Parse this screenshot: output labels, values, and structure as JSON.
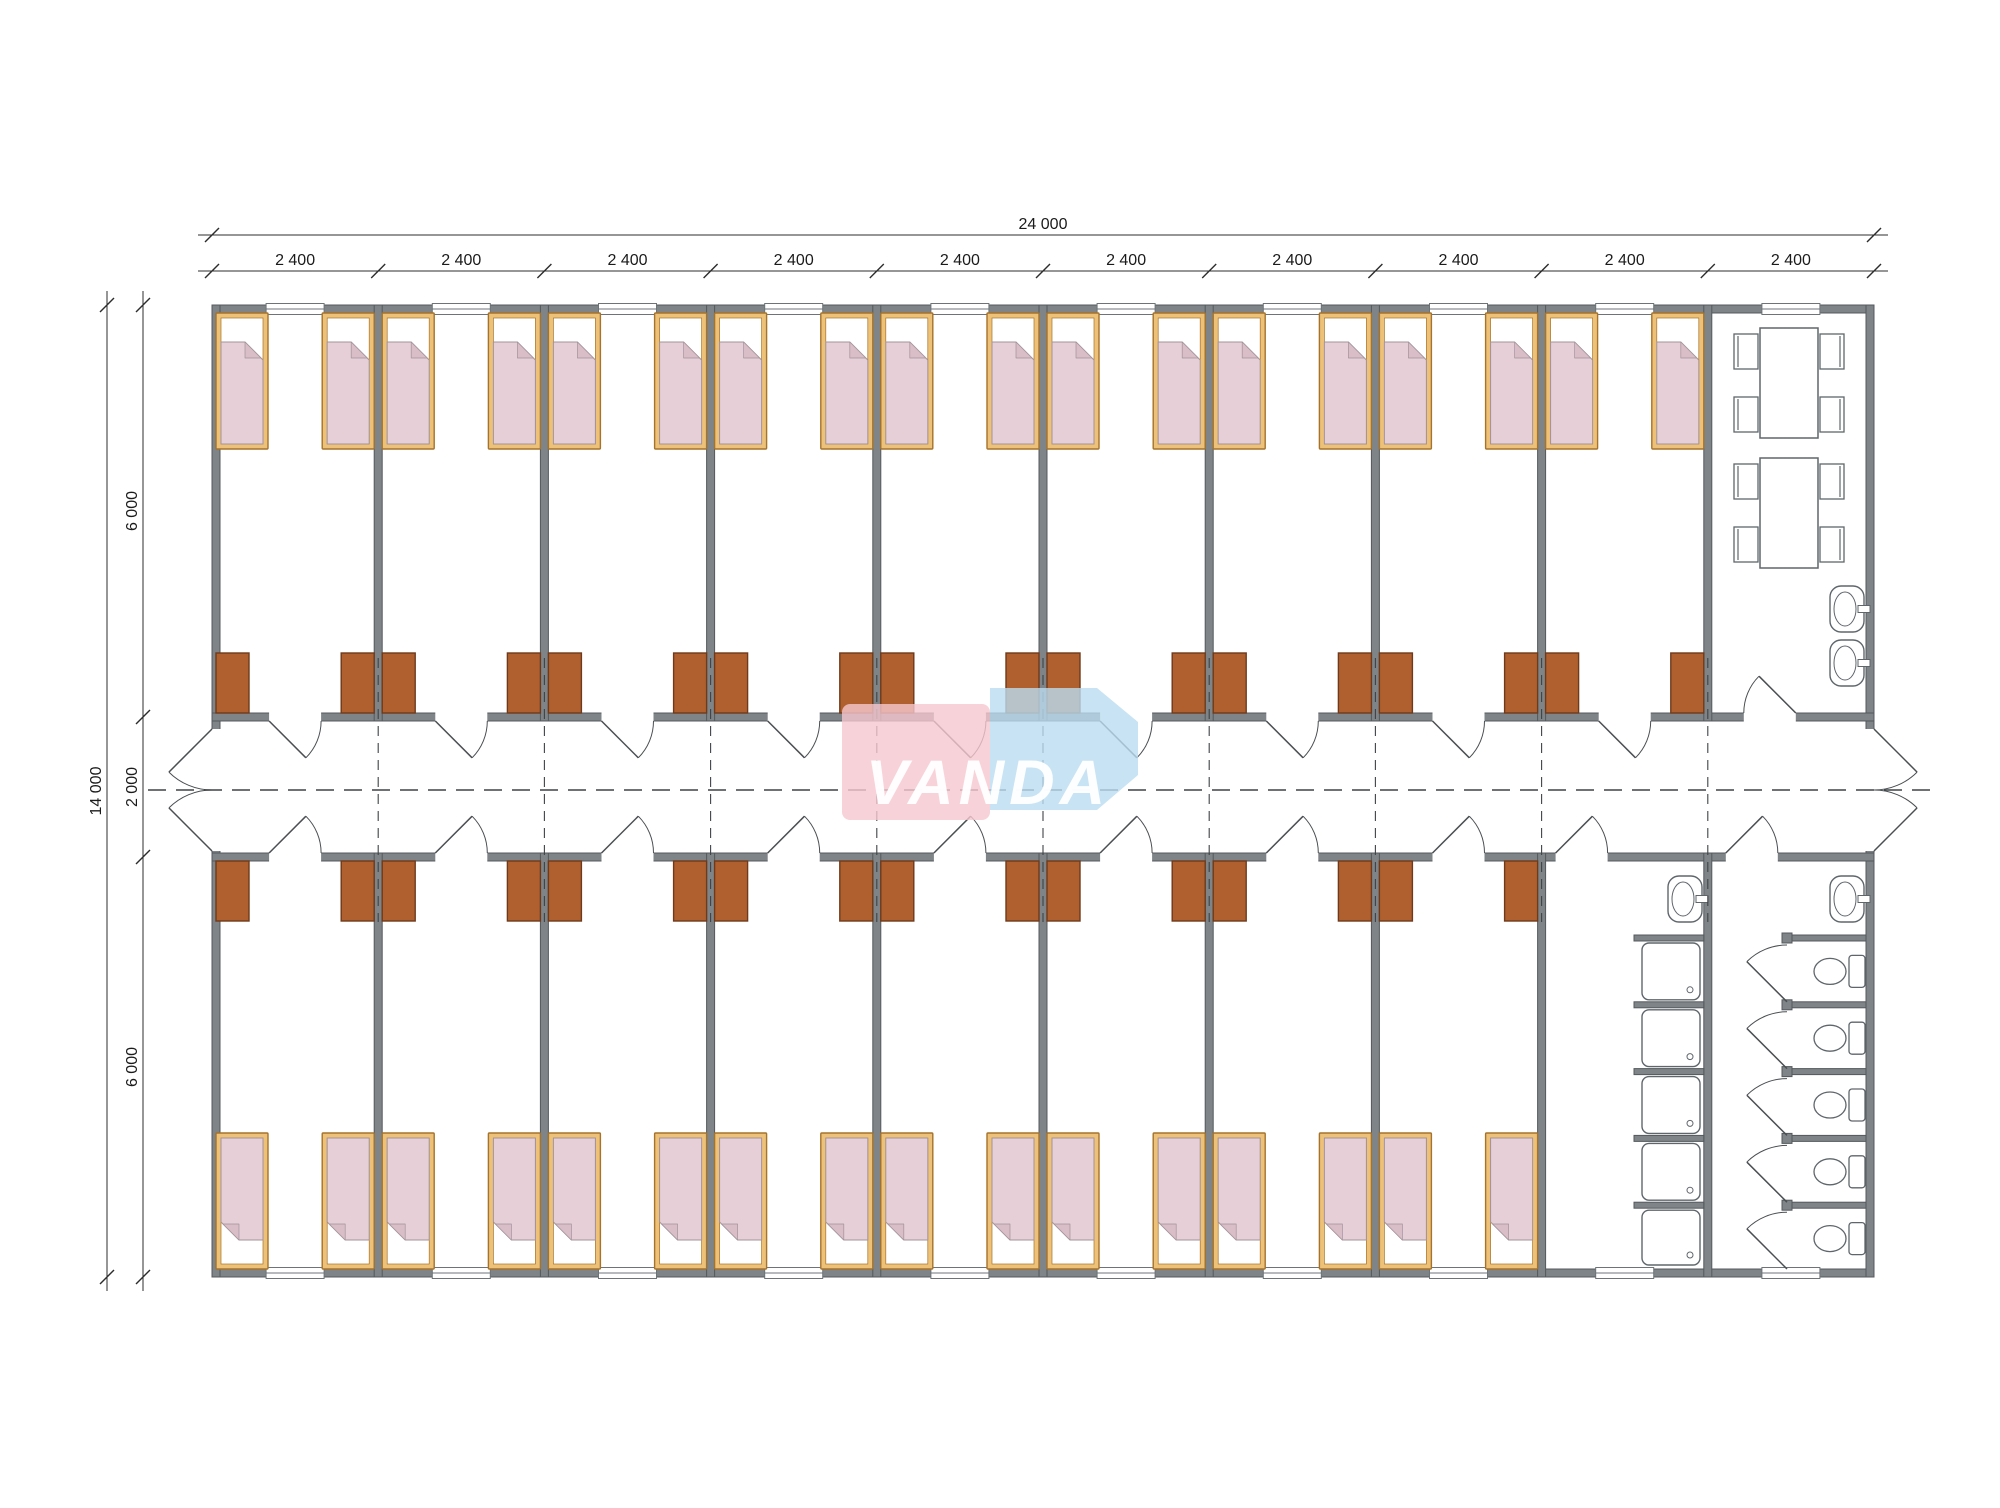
{
  "title": "Modular dormitory floor plan",
  "watermark": {
    "text": "VANDA",
    "pink": "#f6c7cf",
    "blue": "#badcf0",
    "text_color": "#ffffff"
  },
  "dimensions": {
    "total_width_label": "24 000",
    "module_labels": [
      "2 400",
      "2 400",
      "2 400",
      "2 400",
      "2 400",
      "2 400",
      "2 400",
      "2 400",
      "2 400",
      "2 400"
    ],
    "total_height_label": "14 000",
    "height_segment_labels": [
      "6 000",
      "2 000",
      "6 000"
    ]
  },
  "plan": {
    "modules": 10,
    "rooms_top": 9,
    "rooms_bottom": 8,
    "beds_per_room": 2,
    "wardrobes_per_room": 2,
    "dining_tables": 2,
    "chairs_per_table": 4,
    "wash_basins": 4,
    "showers": 5,
    "toilets": 5
  },
  "colors": {
    "wall": "#7e8487",
    "wall_edge": "#54595c",
    "window_line": "#6d7478",
    "bed_frame": "#eec178",
    "bed_frame_edge": "#a5732b",
    "pillow": "#ffffff",
    "blanket": "#e6cfd6",
    "blanket_edge": "#a3949b",
    "blanket_fold": "#d9bdc7",
    "wardrobe": "#b0602f",
    "wardrobe_edge": "#6e3a1b",
    "fixture": "#5f666b",
    "door": "#4a4f52",
    "dash": "#3f4346",
    "dim": "#2c2c2c",
    "dim_text": "#1b1b1b"
  }
}
